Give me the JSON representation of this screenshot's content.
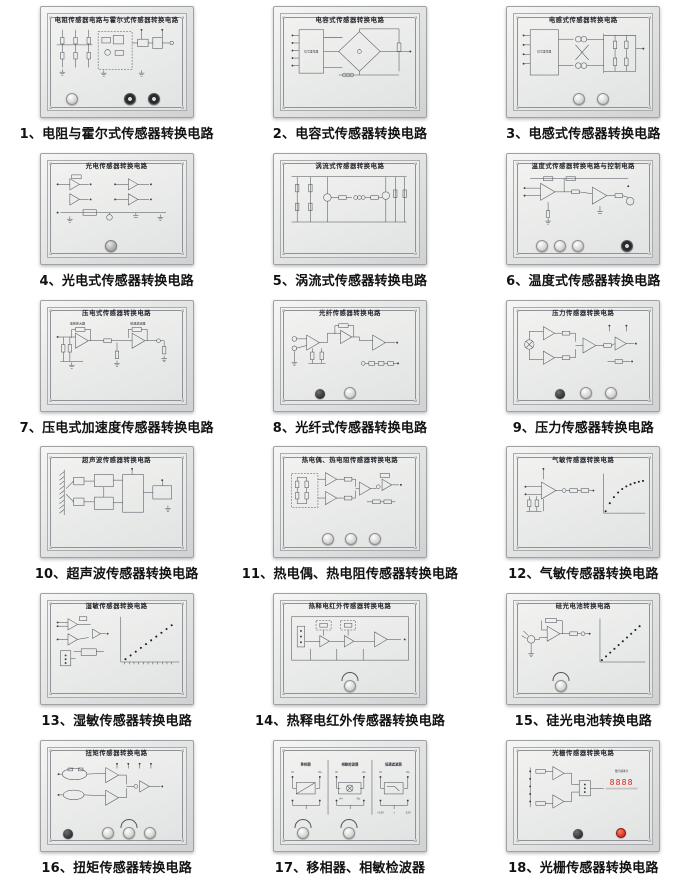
{
  "colors": {
    "board_frame": "#d9dbdc",
    "panel_face": "#eef0ee",
    "circuit_line": "#4a4c55",
    "caption_text": "#121212",
    "display_background": "#181212",
    "display_digits": "#e8211d",
    "red_button": "#cc1e12"
  },
  "panels": [
    {
      "num": "1",
      "caption": "1、电阻与霍尔式传感器转换电路",
      "title": "电阻传感器电路与霍尔式传感器转换电路",
      "knobs": [
        {
          "type": "white",
          "x": 18
        },
        {
          "type": "rotary",
          "x": 60
        },
        {
          "type": "rotary",
          "x": 77
        }
      ]
    },
    {
      "num": "2",
      "caption": "2、电容式传感器转换电路",
      "title": "电容式传感器转换电路",
      "box_label": "信号发生器",
      "knobs": []
    },
    {
      "num": "3",
      "caption": "3、电感式传感器转换电路",
      "title": "电感式传感器转换电路",
      "box_label": "信号发生器",
      "knobs": [
        {
          "type": "white",
          "x": 47
        },
        {
          "type": "white",
          "x": 64
        }
      ]
    },
    {
      "num": "4",
      "caption": "4、光电式传感器转换电路",
      "title": "光电传感器转换电路",
      "knobs": [
        {
          "type": "gray",
          "x": 46
        }
      ]
    },
    {
      "num": "5",
      "caption": "5、涡流式传感器转换电路",
      "title": "涡流式传感器转换电路",
      "knobs": []
    },
    {
      "num": "6",
      "caption": "6、温度式传感器转换电路",
      "title": "温度式传感器转换电路与控制电路",
      "knobs": [
        {
          "type": "white",
          "x": 20
        },
        {
          "type": "white",
          "x": 33
        },
        {
          "type": "white",
          "x": 46
        },
        {
          "type": "rotary",
          "x": 82
        }
      ]
    },
    {
      "num": "7",
      "caption": "7、压电式加速度传感器转换电路",
      "title": "压电式传感器转换电路",
      "labels": [
        "电荷放大器",
        "低通滤波器"
      ],
      "knobs": []
    },
    {
      "num": "8",
      "caption": "8、光纤式传感器转换电路",
      "title": "光纤传感器转换电路",
      "knobs": [
        {
          "type": "black",
          "x": 28
        },
        {
          "type": "white",
          "x": 50
        }
      ]
    },
    {
      "num": "9",
      "caption": "9、压力传感器转换电路",
      "title": "压力传感器转换电路",
      "knobs": [
        {
          "type": "black",
          "x": 33
        },
        {
          "type": "white",
          "x": 52
        },
        {
          "type": "white",
          "x": 70
        }
      ]
    },
    {
      "num": "10",
      "caption": "10、超声波传感器转换电路",
      "title": "超声波传感器转换电路",
      "knobs": []
    },
    {
      "num": "11",
      "caption": "11、热电偶、热电阻传感器转换电路",
      "title": "热电偶、热电阻传感器转换电路",
      "knobs": [
        {
          "type": "white",
          "x": 34
        },
        {
          "type": "white",
          "x": 51
        },
        {
          "type": "white",
          "x": 68
        }
      ]
    },
    {
      "num": "12",
      "caption": "12、气敏传感器转换电路",
      "title": "气敏传感器转换电路",
      "knobs": []
    },
    {
      "num": "13",
      "caption": "13、湿敏传感器转换电路",
      "title": "湿敏传感器转换电路",
      "knobs": []
    },
    {
      "num": "14",
      "caption": "14、热释电红外传感器转换电路",
      "title": "热释电红外传感器转换电路",
      "knobs": [
        {
          "type": "white",
          "x": 50,
          "arc": true
        }
      ]
    },
    {
      "num": "15",
      "caption": "15、硅光电池转换电路",
      "title": "硅光电池转换电路",
      "knobs": [
        {
          "type": "white",
          "x": 34,
          "arc": true
        }
      ]
    },
    {
      "num": "16",
      "caption": "16、扭矩传感器转换电路",
      "title": "扭矩传感器转换电路",
      "knobs": [
        {
          "type": "black",
          "x": 15
        },
        {
          "type": "white",
          "x": 44
        },
        {
          "type": "white",
          "x": 59,
          "arc": true
        },
        {
          "type": "white",
          "x": 74
        }
      ]
    },
    {
      "num": "17",
      "caption": "17、移相器、相敏检波器",
      "title": "",
      "sections": [
        "移相器",
        "相敏检波器",
        "低通滤波器"
      ],
      "labels": [
        "Vi",
        "Vo",
        "+12V",
        "-12V"
      ],
      "knobs": [
        {
          "type": "white",
          "x": 16,
          "arc": true
        },
        {
          "type": "white",
          "x": 49,
          "arc": true
        }
      ]
    },
    {
      "num": "18",
      "caption": "18、光栅传感器转换电路",
      "title": "光栅传感器转换电路",
      "display_value": "8888",
      "knobs": [
        {
          "type": "black",
          "x": 46
        },
        {
          "type": "red",
          "x": 77
        }
      ]
    }
  ]
}
